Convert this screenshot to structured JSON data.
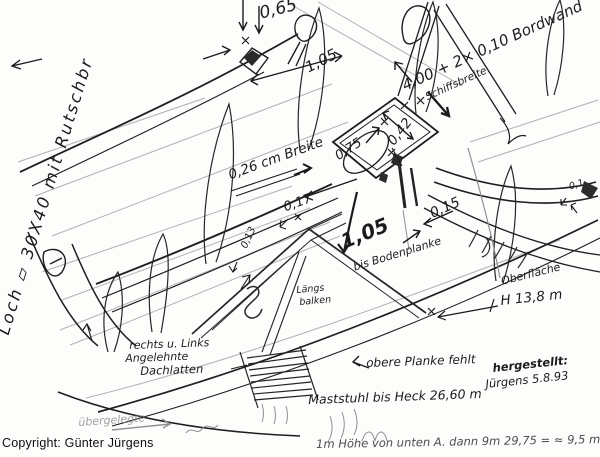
{
  "colors": {
    "ink": "#1c1c1c",
    "pencil": "#8f8f8f",
    "paper": "#fdfdfb"
  },
  "labels": {
    "loch_note": "Loch ▱ 30X40 mit Rutschbr",
    "dim_0_65": "0,65",
    "dim_1_05_top": "1,05",
    "bordwand": "4,00 + 2× 0,10 Bordwand",
    "schiffsbreite": "Schiffsbreite",
    "dim_0_42": "0,42",
    "dim_0_75": "0,75",
    "breite_0_26": "0,26 cm Breite",
    "dim_0_17": "0,17",
    "dim_0_15": "0,15",
    "dim_1_05_boden": "1,05",
    "bis_bodenplanke": "bis Bodenplanke",
    "dim_0_13": "0,13",
    "laengs": "Längs",
    "balken": "balken",
    "rechts_links": "rechts u. Links",
    "angelehnte": "Angelehnte",
    "dachlatten": "Dachlatten",
    "obere_planke": "obere Planke fehlt",
    "maststuhl": "Maststuhl bis Heck 26,60 m",
    "hergestellt": "hergestellt:",
    "juergens_datum": "Jürgens 5.8.93",
    "oberflaeche": "Oberfläche",
    "h_13_8": "H 13,8 m",
    "dim_0_1": "0,1",
    "uebergelegte": "übergelegte",
    "bottom_cut": "1m Höhe von unten A. dann 9m 29,75 = ≈ 9,5 m",
    "copyright": "Copyright: Günter Jürgens"
  }
}
